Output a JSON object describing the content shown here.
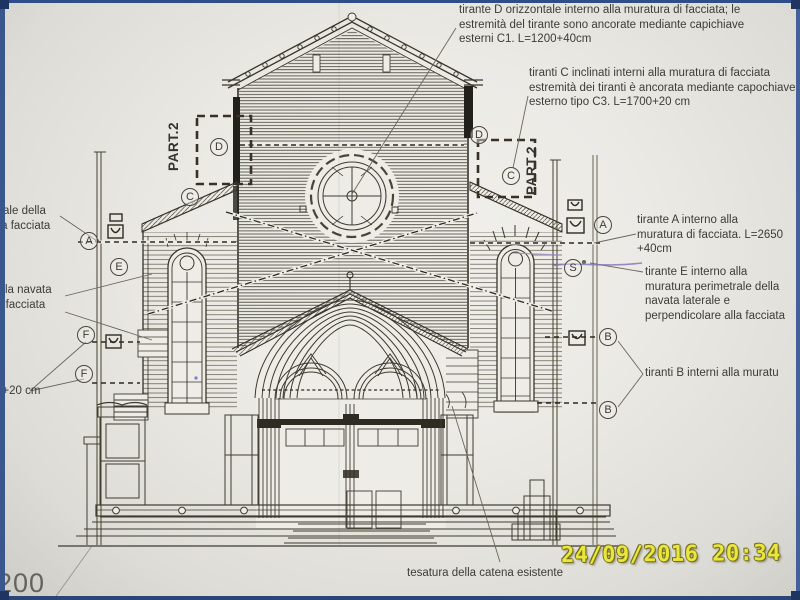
{
  "photo": {
    "date_stamp": "24/09/2016 20:34",
    "date_color": "#eae73c",
    "scale_label": "200"
  },
  "annotations": {
    "tirante_d": {
      "lines": [
        "tirante D orizzontale interno alla muratura di facciata;  le",
        "estremità del tirante sono ancorate mediante capichiave",
        "esterni C1. L=1200+40cm"
      ]
    },
    "tiranti_c": {
      "lines": [
        "tiranti C inclinati interni alla muratura di facciata",
        "estremità dei tiranti è ancorata mediante capochiave",
        "esterno tipo C3. L=1700+20 cm"
      ]
    },
    "left_cut_1": {
      "lines": [
        "trale della",
        "lla facciata"
      ]
    },
    "left_cut_2": {
      "lines": [
        "ella navata",
        "a facciata"
      ]
    },
    "left_cut_3": {
      "lines": [
        "0+20 cm"
      ]
    },
    "tirante_a": {
      "lines": [
        "tirante A  interno alla",
        "muratura di facciata. L=2650",
        "+40cm"
      ]
    },
    "tirante_e": {
      "lines": [
        "tirante E interno alla",
        "muratura perimetrale della",
        "navata laterale e",
        "perpendicolare alla facciata"
      ]
    },
    "tiranti_b": {
      "lines": [
        "tiranti B  interni alla muratu"
      ]
    },
    "tesatura": {
      "lines": [
        "tesatura della catena esistente"
      ]
    },
    "part2_left": "PART.2",
    "part2_right": "PART.2"
  },
  "markers": [
    {
      "label": "A",
      "side": "left"
    },
    {
      "label": "E",
      "side": "left"
    },
    {
      "label": "F",
      "side": "left"
    },
    {
      "label": "F",
      "side": "left"
    },
    {
      "label": "C",
      "side": "left"
    },
    {
      "label": "D",
      "side": "left"
    },
    {
      "label": "D",
      "side": "right"
    },
    {
      "label": "C",
      "side": "right"
    },
    {
      "label": "A",
      "side": "right"
    },
    {
      "label": "S",
      "side": "right"
    },
    {
      "label": "B",
      "side": "right"
    },
    {
      "label": "B",
      "side": "right"
    }
  ],
  "colors": {
    "ink": "#3f3b30",
    "paper": "#eceae5",
    "border_blue": "#3a568f",
    "pen_mark_purple": "#8578b8"
  }
}
